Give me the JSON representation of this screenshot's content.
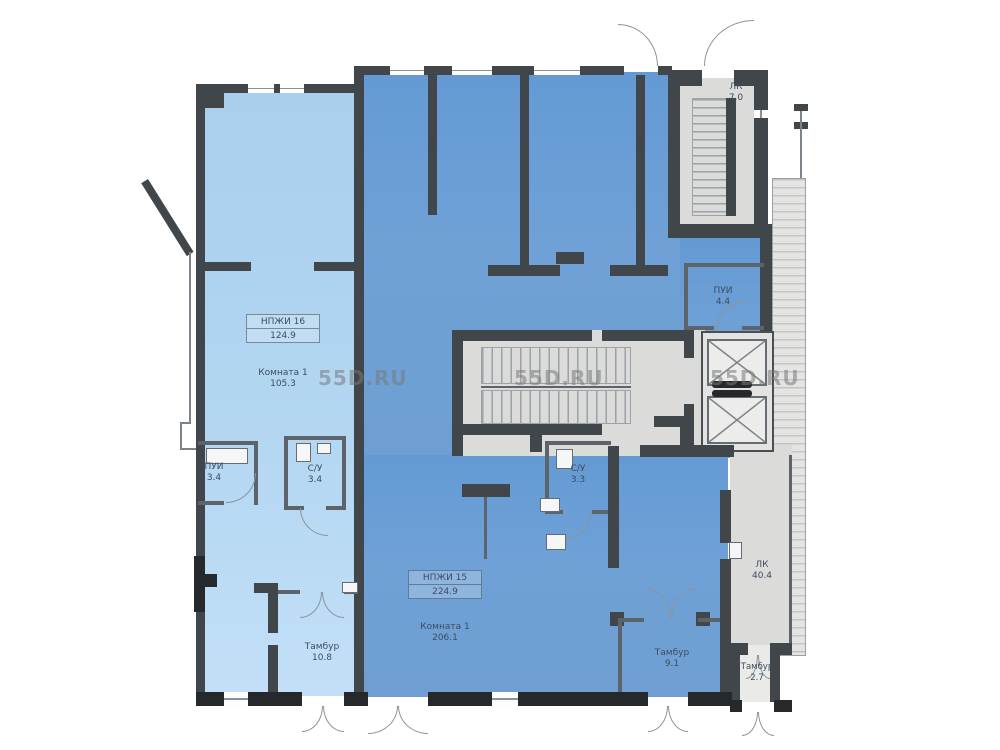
{
  "plan": {
    "watermarks": [
      "55D.RU",
      "55D.RU",
      "55D.RU"
    ],
    "units": {
      "unit16": {
        "code": "НПЖИ 16",
        "total_area": "124.9",
        "room_label": "Комната 1",
        "room_area": "105.3"
      },
      "unit15": {
        "code": "НПЖИ 15",
        "total_area": "224.9",
        "room_label": "Комната 1",
        "room_area": "206.1"
      }
    },
    "small_rooms": {
      "pui_left": {
        "label": "ПУИ",
        "area": "3.4"
      },
      "su_left": {
        "label": "С/У",
        "area": "3.4"
      },
      "su_center": {
        "label": "С/У",
        "area": "3.3"
      },
      "pui_right": {
        "label": "ПУИ",
        "area": "4.4"
      },
      "lk_top": {
        "label": "ЛК",
        "area": "7.0"
      },
      "lk_right": {
        "label": "ЛК",
        "area": "40.4"
      },
      "tambur_left": {
        "label": "Тамбур",
        "area": "10.8"
      },
      "tambur_center": {
        "label": "Тамбур",
        "area": "9.1"
      },
      "tambur_right": {
        "label": "Тамбур",
        "area": "2.7"
      }
    },
    "colors": {
      "unit16_fill": "#aed3ef",
      "unit15_fill": "#6b9ed6",
      "common_fill": "#dcdcda",
      "wall": "#41464b",
      "watermark": "#9a9a9a"
    }
  }
}
